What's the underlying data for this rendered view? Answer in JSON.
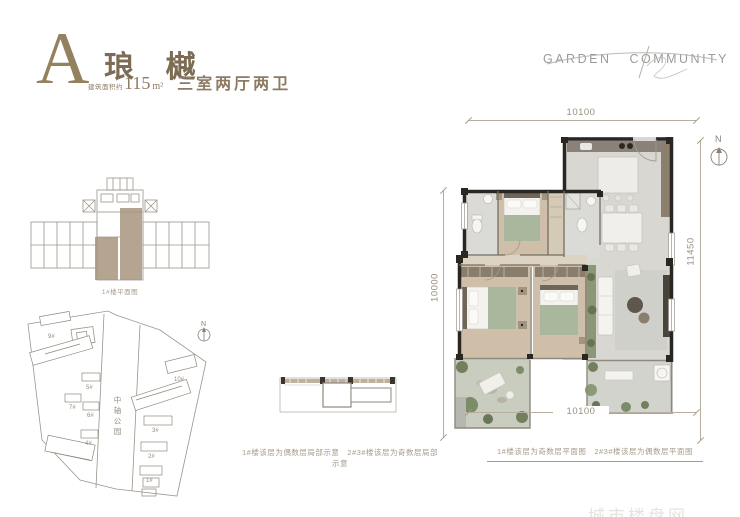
{
  "header": {
    "unit_letter": "A",
    "unit_name": "琅 樾",
    "area_prefix": "建筑面积约",
    "area_value": "115",
    "area_unit": "m²",
    "layout_desc": "三室两厅两卫"
  },
  "logo": {
    "word_left": "GARDEN",
    "word_right": "COMMUNITY"
  },
  "key_plan": {
    "caption": "1#楼平面图"
  },
  "site_plan": {
    "north_label": "N",
    "park_label": "中轴公园",
    "building_labels": [
      "9#",
      "5#",
      "7#",
      "6#",
      "4#",
      "10#",
      "3#",
      "2#",
      "1#"
    ]
  },
  "sketch": {
    "caption": "1#楼该层为偶数层局部示意　2#3#楼该层为奇数层局部示意"
  },
  "main_plan": {
    "north_label": "N",
    "dim_top": "10100",
    "dim_bottom": "10100",
    "dim_left": "10000",
    "dim_right": "11450",
    "caption": "1#楼该层为奇数层平面图　2#3#楼该层为偶数层平面图"
  },
  "watermark": {
    "text": "城市楼盘网"
  },
  "colors": {
    "brand": "#8d7a62",
    "caption": "#a79c8b",
    "logo_gray": "#9b9b99",
    "highlight_tan": "#b5a48f",
    "plan_wall": "#2a2722",
    "wood_floor": "#cfbfa8",
    "light_floor": "#d8d7d2",
    "green_blanket": "#a9b89c",
    "plant_green": "#72815c",
    "line_gray": "#9b958b"
  }
}
